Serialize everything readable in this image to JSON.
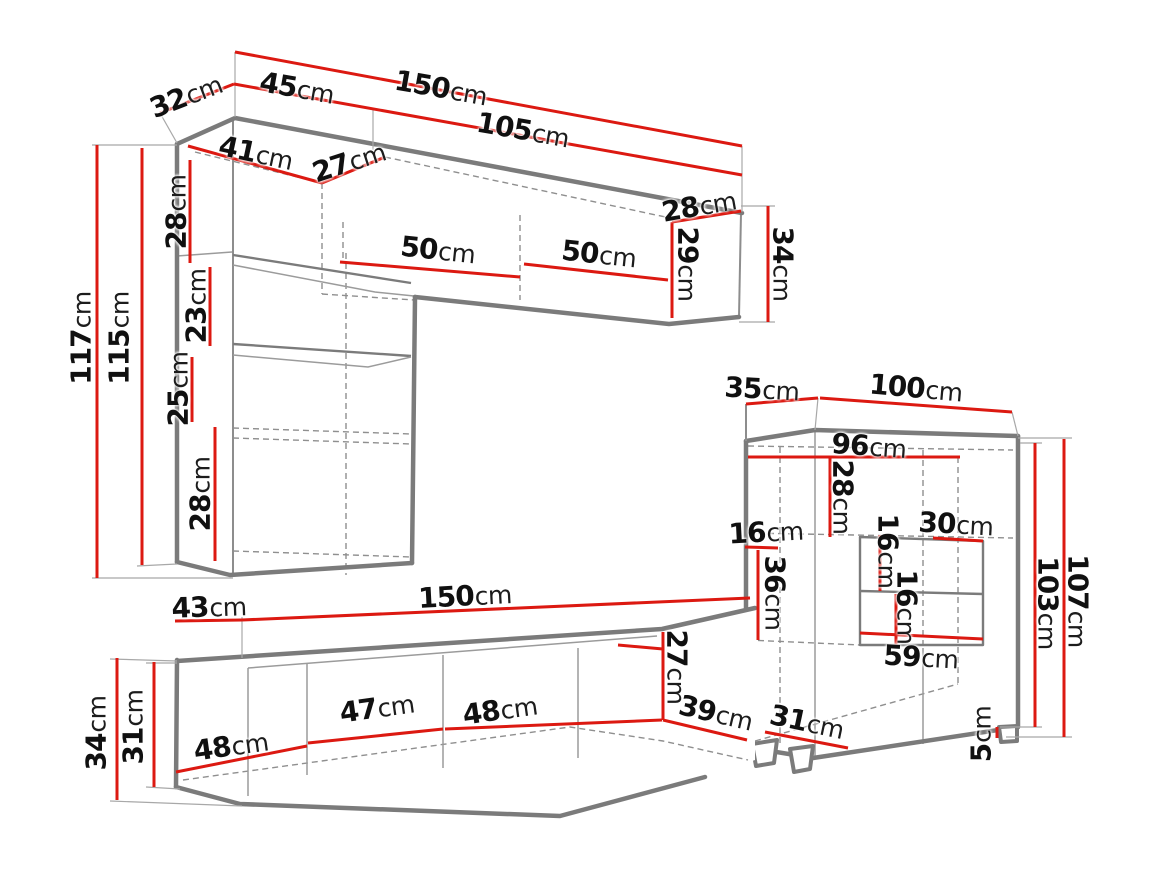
{
  "title": "Wall unit furniture dimension diagram",
  "colors": {
    "dimension_line": "#dc1911",
    "outline": "#7b7b7b",
    "label_text": "#101010",
    "background": "#ffffff"
  },
  "labels": [
    {
      "name": "dim-32-top-depth",
      "value": "32",
      "unit": "cm"
    },
    {
      "name": "dim-45-top",
      "value": "45",
      "unit": "cm"
    },
    {
      "name": "dim-150-top",
      "value": "150",
      "unit": "cm"
    },
    {
      "name": "dim-105-top",
      "value": "105",
      "unit": "cm"
    },
    {
      "name": "dim-41-inner",
      "value": "41",
      "unit": "cm"
    },
    {
      "name": "dim-27-inner-top",
      "value": "27",
      "unit": "cm"
    },
    {
      "name": "dim-28-left-upper",
      "value": "28",
      "unit": "cm"
    },
    {
      "name": "dim-23-left",
      "value": "23",
      "unit": "cm"
    },
    {
      "name": "dim-25-left",
      "value": "25",
      "unit": "cm"
    },
    {
      "name": "dim-28-left-lower",
      "value": "28",
      "unit": "cm"
    },
    {
      "name": "dim-117-height",
      "value": "117",
      "unit": "cm"
    },
    {
      "name": "dim-115-height",
      "value": "115",
      "unit": "cm"
    },
    {
      "name": "dim-50-door-left",
      "value": "50",
      "unit": "cm"
    },
    {
      "name": "dim-50-door-right",
      "value": "50",
      "unit": "cm"
    },
    {
      "name": "dim-28-right-depth",
      "value": "28",
      "unit": "cm"
    },
    {
      "name": "dim-29-right",
      "value": "29",
      "unit": "cm"
    },
    {
      "name": "dim-34-right",
      "value": "34",
      "unit": "cm"
    },
    {
      "name": "dim-35-cabinet-depth",
      "value": "35",
      "unit": "cm"
    },
    {
      "name": "dim-100-cabinet-width",
      "value": "100",
      "unit": "cm"
    },
    {
      "name": "dim-96-cabinet-inner",
      "value": "96",
      "unit": "cm"
    },
    {
      "name": "dim-28-cabinet-inner",
      "value": "28",
      "unit": "cm"
    },
    {
      "name": "dim-16-cabinet-left",
      "value": "16",
      "unit": "cm"
    },
    {
      "name": "dim-36-cabinet",
      "value": "36",
      "unit": "cm"
    },
    {
      "name": "dim-16-niche-upper",
      "value": "16",
      "unit": "cm"
    },
    {
      "name": "dim-16-niche-lower",
      "value": "16",
      "unit": "cm"
    },
    {
      "name": "dim-30-niche",
      "value": "30",
      "unit": "cm"
    },
    {
      "name": "dim-59-niche",
      "value": "59",
      "unit": "cm"
    },
    {
      "name": "dim-107-cabinet-height",
      "value": "107",
      "unit": "cm"
    },
    {
      "name": "dim-103-cabinet-height",
      "value": "103",
      "unit": "cm"
    },
    {
      "name": "dim-31-cabinet-bottom",
      "value": "31",
      "unit": "cm"
    },
    {
      "name": "dim-5-leg-height",
      "value": "5",
      "unit": "cm"
    },
    {
      "name": "dim-43-stand-depth",
      "value": "43",
      "unit": "cm"
    },
    {
      "name": "dim-150-stand-width",
      "value": "150",
      "unit": "cm"
    },
    {
      "name": "dim-27-stand-right",
      "value": "27",
      "unit": "cm"
    },
    {
      "name": "dim-48-stand-left",
      "value": "48",
      "unit": "cm"
    },
    {
      "name": "dim-47-stand-mid",
      "value": "47",
      "unit": "cm"
    },
    {
      "name": "dim-48-stand-right",
      "value": "48",
      "unit": "cm"
    },
    {
      "name": "dim-34-stand-left",
      "value": "34",
      "unit": "cm"
    },
    {
      "name": "dim-31-stand-left",
      "value": "31",
      "unit": "cm"
    },
    {
      "name": "dim-39-stand-bottom",
      "value": "39",
      "unit": "cm"
    }
  ]
}
